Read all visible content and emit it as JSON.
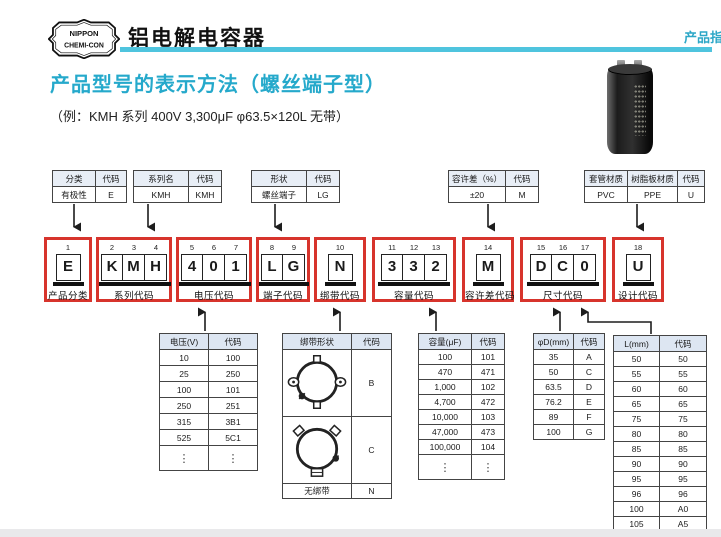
{
  "page": {
    "brand": {
      "logo_line1": "NIPPON",
      "logo_line2": "CHEMI-CON"
    },
    "title": "铝电解电容器",
    "corner_label": "产品指",
    "heading": "产品型号的表示方法（螺丝端子型）",
    "example": "（例：KMH 系列 400V 3,300μF  φ63.5×120L 无带）"
  },
  "colors": {
    "accent_cyan": "#25a9cb",
    "rule_cyan": "#4fc4de",
    "box_red": "#d7342c",
    "table_header_bg": "#dde6f2"
  },
  "legend_tables": [
    {
      "name": "polarity",
      "headers": [
        "分类",
        "代码"
      ],
      "rows": [
        [
          "有极性",
          "E"
        ]
      ]
    },
    {
      "name": "series",
      "headers": [
        "系列名",
        "代码"
      ],
      "rows": [
        [
          "KMH",
          "KMH"
        ]
      ]
    },
    {
      "name": "shape",
      "headers": [
        "形状",
        "代码"
      ],
      "rows": [
        [
          "螺丝端子",
          "LG"
        ]
      ]
    },
    {
      "name": "tolerance",
      "headers": [
        "容许差（%）",
        "代码"
      ],
      "rows": [
        [
          "±20",
          "M"
        ]
      ]
    },
    {
      "name": "sleeve",
      "headers": [
        "套管材质",
        "树脂板材质",
        "代码"
      ],
      "rows": [
        [
          "PVC",
          "PPE",
          "U"
        ]
      ]
    }
  ],
  "code_boxes": [
    {
      "positions": [
        "1"
      ],
      "chars": [
        "E"
      ],
      "label": "产品分类"
    },
    {
      "positions": [
        "2",
        "3",
        "4"
      ],
      "chars": [
        "K",
        "M",
        "H"
      ],
      "label": "系列代码"
    },
    {
      "positions": [
        "5",
        "6",
        "7"
      ],
      "chars": [
        "4",
        "0",
        "1"
      ],
      "label": "电压代码"
    },
    {
      "positions": [
        "8",
        "9"
      ],
      "chars": [
        "L",
        "G"
      ],
      "label": "端子代码"
    },
    {
      "positions": [
        "10"
      ],
      "chars": [
        "N"
      ],
      "label": "绑带代码"
    },
    {
      "positions": [
        "11",
        "12",
        "13"
      ],
      "chars": [
        "3",
        "3",
        "2"
      ],
      "label": "容量代码"
    },
    {
      "positions": [
        "14"
      ],
      "chars": [
        "M"
      ],
      "label": "容许差代码"
    },
    {
      "positions": [
        "15",
        "16",
        "17"
      ],
      "chars": [
        "D",
        "C",
        "0"
      ],
      "label": "尺寸代码"
    },
    {
      "positions": [
        "18"
      ],
      "chars": [
        "U"
      ],
      "label": "设计代码"
    }
  ],
  "code_tables": {
    "voltage": {
      "headers": [
        "电压(V)",
        "代码"
      ],
      "rows": [
        [
          "10",
          "100"
        ],
        [
          "25",
          "250"
        ],
        [
          "100",
          "101"
        ],
        [
          "250",
          "251"
        ],
        [
          "315",
          "3B1"
        ],
        [
          "525",
          "5C1"
        ],
        [
          "⋮",
          "⋮"
        ]
      ]
    },
    "band": {
      "headers": [
        "绑带形状",
        "代码"
      ],
      "rows": [
        [
          "@band-b",
          "B"
        ],
        [
          "@band-c",
          "C"
        ],
        [
          "无绑带",
          "N"
        ]
      ]
    },
    "capacitance": {
      "headers": [
        "容量(μF)",
        "代码"
      ],
      "rows": [
        [
          "100",
          "101"
        ],
        [
          "470",
          "471"
        ],
        [
          "1,000",
          "102"
        ],
        [
          "4,700",
          "472"
        ],
        [
          "10,000",
          "103"
        ],
        [
          "47,000",
          "473"
        ],
        [
          "100,000",
          "104"
        ],
        [
          "⋮",
          "⋮"
        ]
      ]
    },
    "diameter": {
      "headers": [
        "φD(mm)",
        "代码"
      ],
      "rows": [
        [
          "35",
          "A"
        ],
        [
          "50",
          "C"
        ],
        [
          "63.5",
          "D"
        ],
        [
          "76.2",
          "E"
        ],
        [
          "89",
          "F"
        ],
        [
          "100",
          "G"
        ]
      ]
    },
    "length": {
      "headers": [
        "L(mm)",
        "代码"
      ],
      "rows": [
        [
          "50",
          "50"
        ],
        [
          "55",
          "55"
        ],
        [
          "60",
          "60"
        ],
        [
          "65",
          "65"
        ],
        [
          "75",
          "75"
        ],
        [
          "80",
          "80"
        ],
        [
          "85",
          "85"
        ],
        [
          "90",
          "90"
        ],
        [
          "95",
          "95"
        ],
        [
          "96",
          "96"
        ],
        [
          "100",
          "A0"
        ],
        [
          "105",
          "A5"
        ],
        [
          "110",
          "B0"
        ]
      ]
    }
  }
}
